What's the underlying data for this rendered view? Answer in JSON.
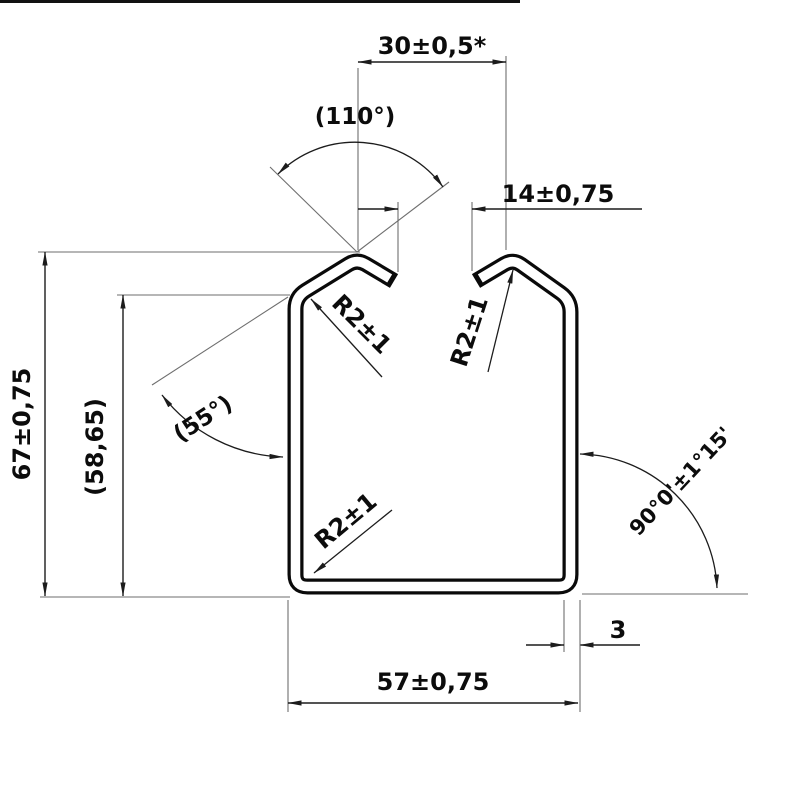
{
  "colors": {
    "line": "#0a0a0a",
    "extension_line": "#6e6e6e",
    "background": "#ffffff"
  },
  "drawing": {
    "labels": {
      "dim30": "30±0,5*",
      "dim14": "14±0,75",
      "dim67": "67±0,75",
      "dim58": "(58,65)",
      "ang110": "(110°)",
      "ang55": "(55°)",
      "ang90": "90°0'±1°15'",
      "dim57": "57±0,75",
      "dim3": "3",
      "r2_top_left": "R2±1",
      "r2_bottom_left": "R2±1",
      "r2_right": "R2±1"
    }
  }
}
